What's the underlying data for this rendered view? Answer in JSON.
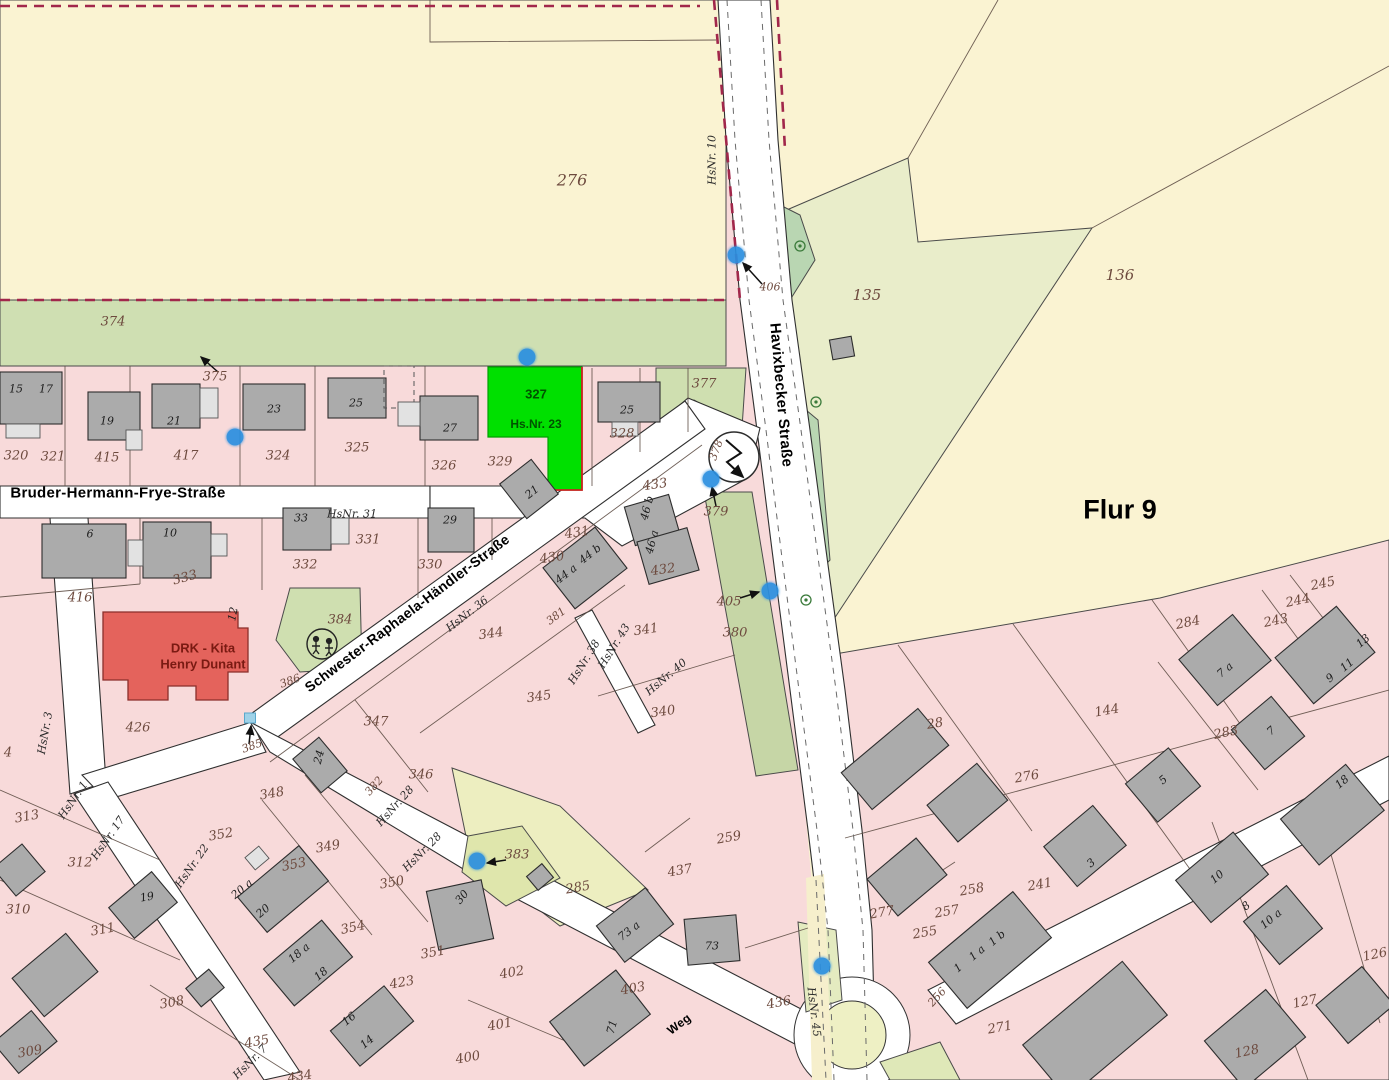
{
  "map": {
    "flur_label": "Flur 9",
    "streets": {
      "bruder": "Bruder-Hermann-Frye-Straße",
      "schwester": "Schwester-Raphaela-Händler-Straße",
      "havixbecker": "Havixbecker Straße",
      "weg": "Weg"
    },
    "highlight_parcel": {
      "number": "327",
      "house": "Hs.Nr. 23"
    },
    "kita": {
      "line1": "DRK - Kita",
      "line2": "Henry Dunant"
    },
    "colors": {
      "highlight": "#00e000",
      "highlight_text": "#005200",
      "kita": "#e4635c",
      "marker": "#2a8fe0",
      "dash_red": "#a1274b",
      "field": "#faf3d2",
      "green_strip": "#cfdfb2",
      "pink": "#f8dada",
      "road": "#ffffff",
      "building": "#ababab"
    },
    "markers": {
      "dots": [
        [
          736,
          255
        ],
        [
          527,
          357
        ],
        [
          235,
          437
        ],
        [
          711,
          479
        ],
        [
          770,
          591
        ],
        [
          477,
          861
        ],
        [
          822,
          966
        ]
      ],
      "squares": [
        [
          250,
          718
        ]
      ]
    },
    "labels": [
      {
        "t": "Bruder-Hermann-Frye-Straße",
        "x": 118,
        "y": 493,
        "k": "s"
      },
      {
        "t": "Schwester-Raphaela-Händler-Straße",
        "x": 407,
        "y": 613,
        "r": -37,
        "k": "s",
        "s": 14
      },
      {
        "t": "Havixbecker Straße",
        "x": 781,
        "y": 395,
        "r": 85,
        "k": "s"
      },
      {
        "t": "Weg",
        "x": 679,
        "y": 1024,
        "r": -37,
        "k": "s",
        "s": 12
      },
      {
        "t": "Flur 9",
        "x": 1120,
        "y": 510,
        "k": "f"
      },
      {
        "t": "327",
        "x": 536,
        "y": 394,
        "k": "g",
        "s": 13
      },
      {
        "t": "Hs.Nr. 23",
        "x": 536,
        "y": 424,
        "k": "g"
      },
      {
        "t": "DRK - Kita",
        "x": 203,
        "y": 648,
        "k": "k"
      },
      {
        "t": "Henry Dunant",
        "x": 203,
        "y": 664,
        "k": "k"
      },
      {
        "t": "276",
        "x": 572,
        "y": 180,
        "k": "p",
        "s": 16
      },
      {
        "t": "374",
        "x": 113,
        "y": 322,
        "k": "p"
      },
      {
        "t": "375",
        "x": 215,
        "y": 377,
        "k": "p"
      },
      {
        "t": "320",
        "x": 16,
        "y": 456,
        "k": "p"
      },
      {
        "t": "321",
        "x": 53,
        "y": 457,
        "k": "p"
      },
      {
        "t": "415",
        "x": 107,
        "y": 458,
        "k": "p"
      },
      {
        "t": "417",
        "x": 186,
        "y": 456,
        "k": "p"
      },
      {
        "t": "324",
        "x": 278,
        "y": 456,
        "k": "p"
      },
      {
        "t": "325",
        "x": 357,
        "y": 448,
        "k": "p"
      },
      {
        "t": "326",
        "x": 444,
        "y": 466,
        "k": "p"
      },
      {
        "t": "329",
        "x": 500,
        "y": 462,
        "k": "p"
      },
      {
        "t": "328",
        "x": 622,
        "y": 434,
        "k": "p"
      },
      {
        "t": "377",
        "x": 704,
        "y": 384,
        "k": "p"
      },
      {
        "t": "378",
        "x": 716,
        "y": 450,
        "r": -70,
        "k": "p",
        "s": 11
      },
      {
        "t": "406",
        "x": 770,
        "y": 287,
        "k": "p",
        "s": 11
      },
      {
        "t": "135",
        "x": 867,
        "y": 295,
        "k": "p",
        "s": 15
      },
      {
        "t": "136",
        "x": 1120,
        "y": 275,
        "k": "p",
        "s": 15
      },
      {
        "t": "433",
        "x": 655,
        "y": 485,
        "r": -8,
        "k": "p"
      },
      {
        "t": "431",
        "x": 577,
        "y": 533,
        "r": -8,
        "k": "p"
      },
      {
        "t": "430",
        "x": 552,
        "y": 558,
        "r": -8,
        "k": "p"
      },
      {
        "t": "432",
        "x": 663,
        "y": 570,
        "r": -8,
        "k": "p"
      },
      {
        "t": "379",
        "x": 716,
        "y": 512,
        "k": "p"
      },
      {
        "t": "405",
        "x": 729,
        "y": 602,
        "k": "p"
      },
      {
        "t": "380",
        "x": 735,
        "y": 633,
        "k": "p"
      },
      {
        "t": "381",
        "x": 556,
        "y": 616,
        "r": -37,
        "k": "p",
        "s": 11
      },
      {
        "t": "341",
        "x": 646,
        "y": 630,
        "r": -8,
        "k": "p"
      },
      {
        "t": "340",
        "x": 663,
        "y": 712,
        "r": -8,
        "k": "p"
      },
      {
        "t": "344",
        "x": 491,
        "y": 634,
        "r": -8,
        "k": "p"
      },
      {
        "t": "345",
        "x": 539,
        "y": 697,
        "r": -8,
        "k": "p"
      },
      {
        "t": "347",
        "x": 376,
        "y": 722,
        "k": "p"
      },
      {
        "t": "346",
        "x": 421,
        "y": 775,
        "k": "p"
      },
      {
        "t": "384",
        "x": 340,
        "y": 620,
        "k": "p"
      },
      {
        "t": "386",
        "x": 290,
        "y": 681,
        "r": -20,
        "k": "p",
        "s": 11
      },
      {
        "t": "385",
        "x": 252,
        "y": 746,
        "r": -20,
        "k": "p",
        "s": 11
      },
      {
        "t": "426",
        "x": 138,
        "y": 728,
        "k": "p"
      },
      {
        "t": "416",
        "x": 80,
        "y": 598,
        "k": "p"
      },
      {
        "t": "333",
        "x": 185,
        "y": 578,
        "r": -15,
        "k": "p"
      },
      {
        "t": "332",
        "x": 305,
        "y": 565,
        "k": "p"
      },
      {
        "t": "331",
        "x": 368,
        "y": 540,
        "k": "p"
      },
      {
        "t": "330",
        "x": 430,
        "y": 565,
        "k": "p"
      },
      {
        "t": "313",
        "x": 27,
        "y": 817,
        "r": -10,
        "k": "p"
      },
      {
        "t": "4",
        "x": 8,
        "y": 753,
        "k": "p"
      },
      {
        "t": "312",
        "x": 80,
        "y": 863,
        "k": "p"
      },
      {
        "t": "310",
        "x": 18,
        "y": 910,
        "k": "p"
      },
      {
        "t": "311",
        "x": 103,
        "y": 930,
        "r": -10,
        "k": "p"
      },
      {
        "t": "352",
        "x": 221,
        "y": 835,
        "r": -10,
        "k": "p"
      },
      {
        "t": "348",
        "x": 272,
        "y": 794,
        "r": -10,
        "k": "p"
      },
      {
        "t": "349",
        "x": 328,
        "y": 847,
        "r": -10,
        "k": "p"
      },
      {
        "t": "353",
        "x": 294,
        "y": 865,
        "r": -12,
        "k": "p"
      },
      {
        "t": "350",
        "x": 392,
        "y": 883,
        "r": -10,
        "k": "p"
      },
      {
        "t": "354",
        "x": 353,
        "y": 928,
        "r": -12,
        "k": "p"
      },
      {
        "t": "351",
        "x": 433,
        "y": 953,
        "r": -10,
        "k": "p"
      },
      {
        "t": "423",
        "x": 402,
        "y": 983,
        "r": -10,
        "k": "p"
      },
      {
        "t": "435",
        "x": 257,
        "y": 1042,
        "r": -10,
        "k": "p"
      },
      {
        "t": "434",
        "x": 300,
        "y": 1077,
        "r": -10,
        "k": "p"
      },
      {
        "t": "382",
        "x": 374,
        "y": 786,
        "r": -48,
        "k": "p",
        "s": 11
      },
      {
        "t": "383",
        "x": 517,
        "y": 855,
        "k": "p"
      },
      {
        "t": "285",
        "x": 578,
        "y": 888,
        "r": -10,
        "k": "p"
      },
      {
        "t": "437",
        "x": 680,
        "y": 871,
        "r": -10,
        "k": "p"
      },
      {
        "t": "259",
        "x": 729,
        "y": 838,
        "r": -10,
        "k": "p"
      },
      {
        "t": "402",
        "x": 512,
        "y": 973,
        "r": -10,
        "k": "p"
      },
      {
        "t": "401",
        "x": 500,
        "y": 1025,
        "r": -10,
        "k": "p"
      },
      {
        "t": "400",
        "x": 468,
        "y": 1058,
        "r": -10,
        "k": "p"
      },
      {
        "t": "403",
        "x": 633,
        "y": 989,
        "r": -10,
        "k": "p"
      },
      {
        "t": "436",
        "x": 779,
        "y": 1003,
        "r": -10,
        "k": "p"
      },
      {
        "t": "277",
        "x": 882,
        "y": 913,
        "r": -10,
        "k": "p"
      },
      {
        "t": "255",
        "x": 925,
        "y": 933,
        "r": -10,
        "k": "p"
      },
      {
        "t": "257",
        "x": 947,
        "y": 912,
        "r": -10,
        "k": "p"
      },
      {
        "t": "258",
        "x": 972,
        "y": 890,
        "r": -10,
        "k": "p"
      },
      {
        "t": "256",
        "x": 937,
        "y": 997,
        "r": -48,
        "k": "p",
        "s": 11
      },
      {
        "t": "271",
        "x": 1000,
        "y": 1028,
        "r": -10,
        "k": "p"
      },
      {
        "t": "241",
        "x": 1040,
        "y": 885,
        "r": -10,
        "k": "p"
      },
      {
        "t": "28",
        "x": 935,
        "y": 724,
        "r": -10,
        "k": "p"
      },
      {
        "t": "276",
        "x": 1027,
        "y": 777,
        "r": -10,
        "k": "p"
      },
      {
        "t": "144",
        "x": 1107,
        "y": 711,
        "r": -10,
        "k": "p"
      },
      {
        "t": "284",
        "x": 1188,
        "y": 623,
        "r": -12,
        "k": "p"
      },
      {
        "t": "283",
        "x": 1226,
        "y": 733,
        "r": -12,
        "k": "p"
      },
      {
        "t": "243",
        "x": 1276,
        "y": 621,
        "r": -12,
        "k": "p"
      },
      {
        "t": "244",
        "x": 1298,
        "y": 601,
        "r": -12,
        "k": "p"
      },
      {
        "t": "245",
        "x": 1323,
        "y": 584,
        "r": -12,
        "k": "p"
      },
      {
        "t": "126",
        "x": 1375,
        "y": 955,
        "r": -12,
        "k": "p"
      },
      {
        "t": "127",
        "x": 1305,
        "y": 1002,
        "r": -12,
        "k": "p"
      },
      {
        "t": "128",
        "x": 1247,
        "y": 1052,
        "r": -12,
        "k": "p"
      },
      {
        "t": "308",
        "x": 172,
        "y": 1003,
        "r": -10,
        "k": "p"
      },
      {
        "t": "309",
        "x": 30,
        "y": 1052,
        "r": -10,
        "k": "p"
      },
      {
        "t": "15",
        "x": 16,
        "y": 389,
        "k": "h"
      },
      {
        "t": "17",
        "x": 46,
        "y": 389,
        "k": "h"
      },
      {
        "t": "19",
        "x": 107,
        "y": 421,
        "k": "h"
      },
      {
        "t": "21",
        "x": 174,
        "y": 421,
        "k": "h"
      },
      {
        "t": "23",
        "x": 274,
        "y": 409,
        "k": "h"
      },
      {
        "t": "25",
        "x": 356,
        "y": 403,
        "k": "h"
      },
      {
        "t": "27",
        "x": 450,
        "y": 428,
        "k": "h"
      },
      {
        "t": "25",
        "x": 627,
        "y": 410,
        "k": "h"
      },
      {
        "t": "29",
        "x": 450,
        "y": 520,
        "k": "h"
      },
      {
        "t": "33",
        "x": 301,
        "y": 518,
        "k": "h"
      },
      {
        "t": "6",
        "x": 90,
        "y": 534,
        "k": "h"
      },
      {
        "t": "10",
        "x": 170,
        "y": 533,
        "k": "h"
      },
      {
        "t": "21",
        "x": 532,
        "y": 492,
        "r": -38,
        "k": "h"
      },
      {
        "t": "12",
        "x": 233,
        "y": 614,
        "r": -78,
        "k": "h"
      },
      {
        "t": "44 a",
        "x": 566,
        "y": 574,
        "r": -38,
        "k": "h"
      },
      {
        "t": "44 b",
        "x": 590,
        "y": 554,
        "r": -38,
        "k": "h"
      },
      {
        "t": "46 b",
        "x": 647,
        "y": 508,
        "r": -75,
        "k": "h"
      },
      {
        "t": "46 a",
        "x": 652,
        "y": 542,
        "r": -75,
        "k": "h"
      },
      {
        "t": "24",
        "x": 319,
        "y": 757,
        "r": -75,
        "k": "h"
      },
      {
        "t": "19",
        "x": 147,
        "y": 897,
        "r": -10,
        "k": "h"
      },
      {
        "t": "20 a",
        "x": 242,
        "y": 889,
        "r": -40,
        "k": "h"
      },
      {
        "t": "20",
        "x": 263,
        "y": 911,
        "r": -40,
        "k": "h"
      },
      {
        "t": "18 a",
        "x": 299,
        "y": 953,
        "r": -40,
        "k": "h"
      },
      {
        "t": "18",
        "x": 321,
        "y": 974,
        "r": -40,
        "k": "h"
      },
      {
        "t": "16",
        "x": 349,
        "y": 1019,
        "r": -40,
        "k": "h"
      },
      {
        "t": "14",
        "x": 367,
        "y": 1042,
        "r": -40,
        "k": "h"
      },
      {
        "t": "30",
        "x": 462,
        "y": 897,
        "r": -50,
        "k": "h"
      },
      {
        "t": "73 a",
        "x": 629,
        "y": 931,
        "r": -38,
        "k": "h"
      },
      {
        "t": "73",
        "x": 712,
        "y": 946,
        "k": "h"
      },
      {
        "t": "71",
        "x": 612,
        "y": 1027,
        "r": -75,
        "k": "h"
      },
      {
        "t": "7 a",
        "x": 1225,
        "y": 670,
        "r": -40,
        "k": "h"
      },
      {
        "t": "7",
        "x": 1271,
        "y": 731,
        "r": -40,
        "k": "h"
      },
      {
        "t": "9",
        "x": 1330,
        "y": 678,
        "r": -40,
        "k": "h"
      },
      {
        "t": "11",
        "x": 1347,
        "y": 665,
        "r": -40,
        "k": "h"
      },
      {
        "t": "13",
        "x": 1363,
        "y": 641,
        "r": -40,
        "k": "h"
      },
      {
        "t": "5",
        "x": 1163,
        "y": 780,
        "r": -40,
        "k": "h"
      },
      {
        "t": "3",
        "x": 1091,
        "y": 863,
        "r": -40,
        "k": "h"
      },
      {
        "t": "1",
        "x": 958,
        "y": 968,
        "r": -40,
        "k": "h"
      },
      {
        "t": "1 a",
        "x": 977,
        "y": 953,
        "r": -40,
        "k": "h"
      },
      {
        "t": "1 b",
        "x": 997,
        "y": 938,
        "r": -40,
        "k": "h"
      },
      {
        "t": "10",
        "x": 1217,
        "y": 877,
        "r": -40,
        "k": "h"
      },
      {
        "t": "8",
        "x": 1246,
        "y": 906,
        "r": -40,
        "k": "h"
      },
      {
        "t": "10 a",
        "x": 1271,
        "y": 919,
        "r": -40,
        "k": "h"
      },
      {
        "t": "18",
        "x": 1342,
        "y": 782,
        "r": -40,
        "k": "h"
      },
      {
        "t": "HsNr. 10",
        "x": 712,
        "y": 160,
        "r": -90,
        "k": "n"
      },
      {
        "t": "HsNr. 31",
        "x": 352,
        "y": 514,
        "k": "n"
      },
      {
        "t": "HsNr. 36",
        "x": 467,
        "y": 614,
        "r": -38,
        "k": "n"
      },
      {
        "t": "HsNr. 38",
        "x": 584,
        "y": 662,
        "r": -58,
        "k": "n"
      },
      {
        "t": "HsNr. 43",
        "x": 614,
        "y": 646,
        "r": -58,
        "k": "n"
      },
      {
        "t": "HsNr. 40",
        "x": 666,
        "y": 677,
        "r": -40,
        "k": "n"
      },
      {
        "t": "HsNr. 3",
        "x": 45,
        "y": 733,
        "r": -80,
        "k": "n"
      },
      {
        "t": "HsNr. 1",
        "x": 73,
        "y": 800,
        "r": -55,
        "k": "n"
      },
      {
        "t": "HsNr. 17",
        "x": 108,
        "y": 838,
        "r": -55,
        "k": "n"
      },
      {
        "t": "HsNr. 22",
        "x": 192,
        "y": 866,
        "r": -55,
        "k": "n"
      },
      {
        "t": "HsNr. 28",
        "x": 395,
        "y": 806,
        "r": -48,
        "k": "n"
      },
      {
        "t": "HsNr. 28",
        "x": 422,
        "y": 852,
        "r": -45,
        "k": "n"
      },
      {
        "t": "HsNr. 7",
        "x": 250,
        "y": 1062,
        "r": -45,
        "k": "n"
      },
      {
        "t": "HsNr. 45",
        "x": 814,
        "y": 1012,
        "r": 83,
        "k": "n"
      }
    ]
  }
}
